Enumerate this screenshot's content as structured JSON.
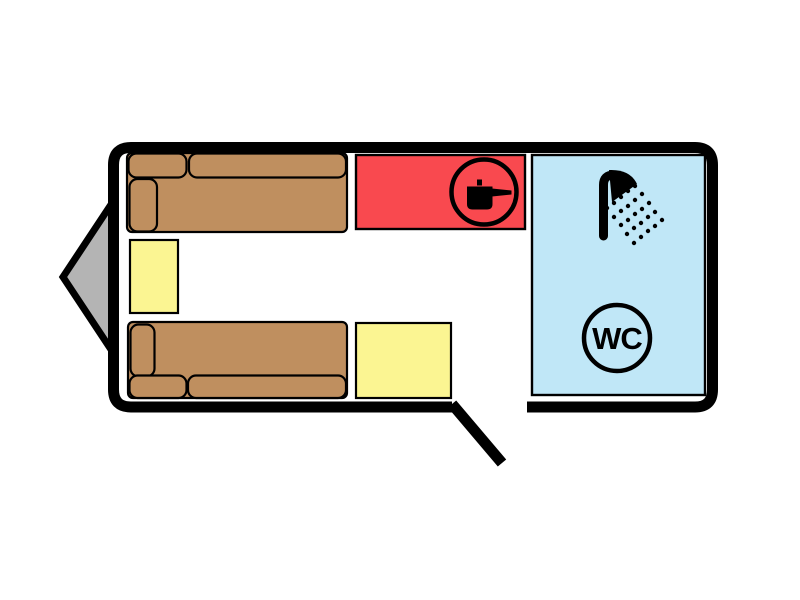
{
  "colors": {
    "background": "#ffffff",
    "wall": "#000000",
    "outline": "#000000",
    "sofa": "#bf8f5f",
    "table": "#fbf592",
    "kitchen": "#f9494f",
    "bathroom": "#c0e7f7",
    "drawbar": "#b4b4b4",
    "icon": "#000000"
  },
  "floor_plan": {
    "kind": "caravan-floor-plan",
    "door": {
      "state": "open"
    },
    "rooms": {
      "kitchen": {
        "icon": "cooking-pot-icon"
      },
      "bathroom": {
        "shower_icon": "shower-icon",
        "wc_icon": "wc-badge",
        "wc_label": "WC"
      }
    },
    "furniture": {
      "front_sofa": "sofa-bed",
      "rear_sofa": "sofa-bed",
      "side_table": "table",
      "entry_table": "table",
      "drawbar": "tow-hitch-triangle"
    }
  }
}
